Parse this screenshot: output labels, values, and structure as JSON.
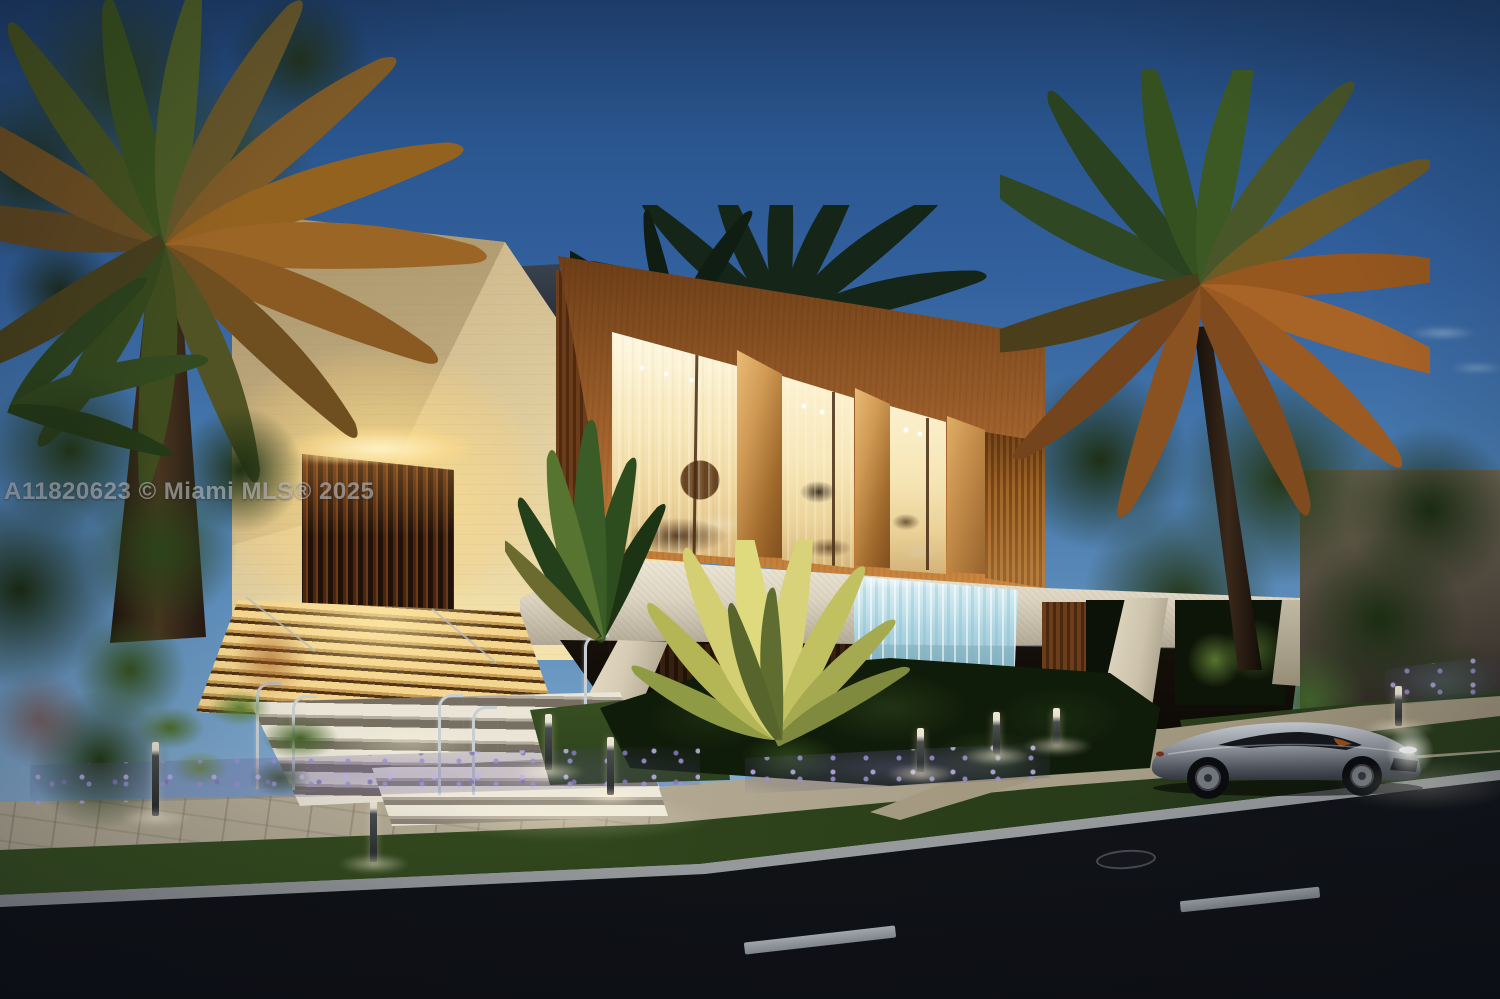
{
  "scene": {
    "type": "real-estate-listing-photo",
    "description": "Twilight 3D rendering of a modern two-story residence: travertine entry tower with glowing slatted door and illuminated stairs, wood-clad upper volume with three floor-to-ceiling window bays, terrazzo ground band with cascading waterfall feature, tropical landscaping with palms and lavender, and a silver sports car parked on the street"
  },
  "watermark": {
    "text": "A11820623 © Miami MLS® 2025"
  },
  "colors": {
    "sky_top": "#24497c",
    "sky_horizon": "#8fb4d6",
    "travertine": "#f0dfab",
    "wood_cladding": "#b06c2c",
    "window_glow": "#f8e9bd",
    "stone_band": "#ded6c2",
    "waterfall_blue": "#aee0ef",
    "foliage_dark": "#1c2c15",
    "lit_foliage": "#d3cf72",
    "lavender": "#9a8fd0",
    "lawn": "#3c5522",
    "sidewalk": "#b3a993",
    "road": "#14171d",
    "lane_marking": "#c9ced3",
    "car_silver": "#9aa0a8",
    "step_light": "#f4d58e"
  }
}
